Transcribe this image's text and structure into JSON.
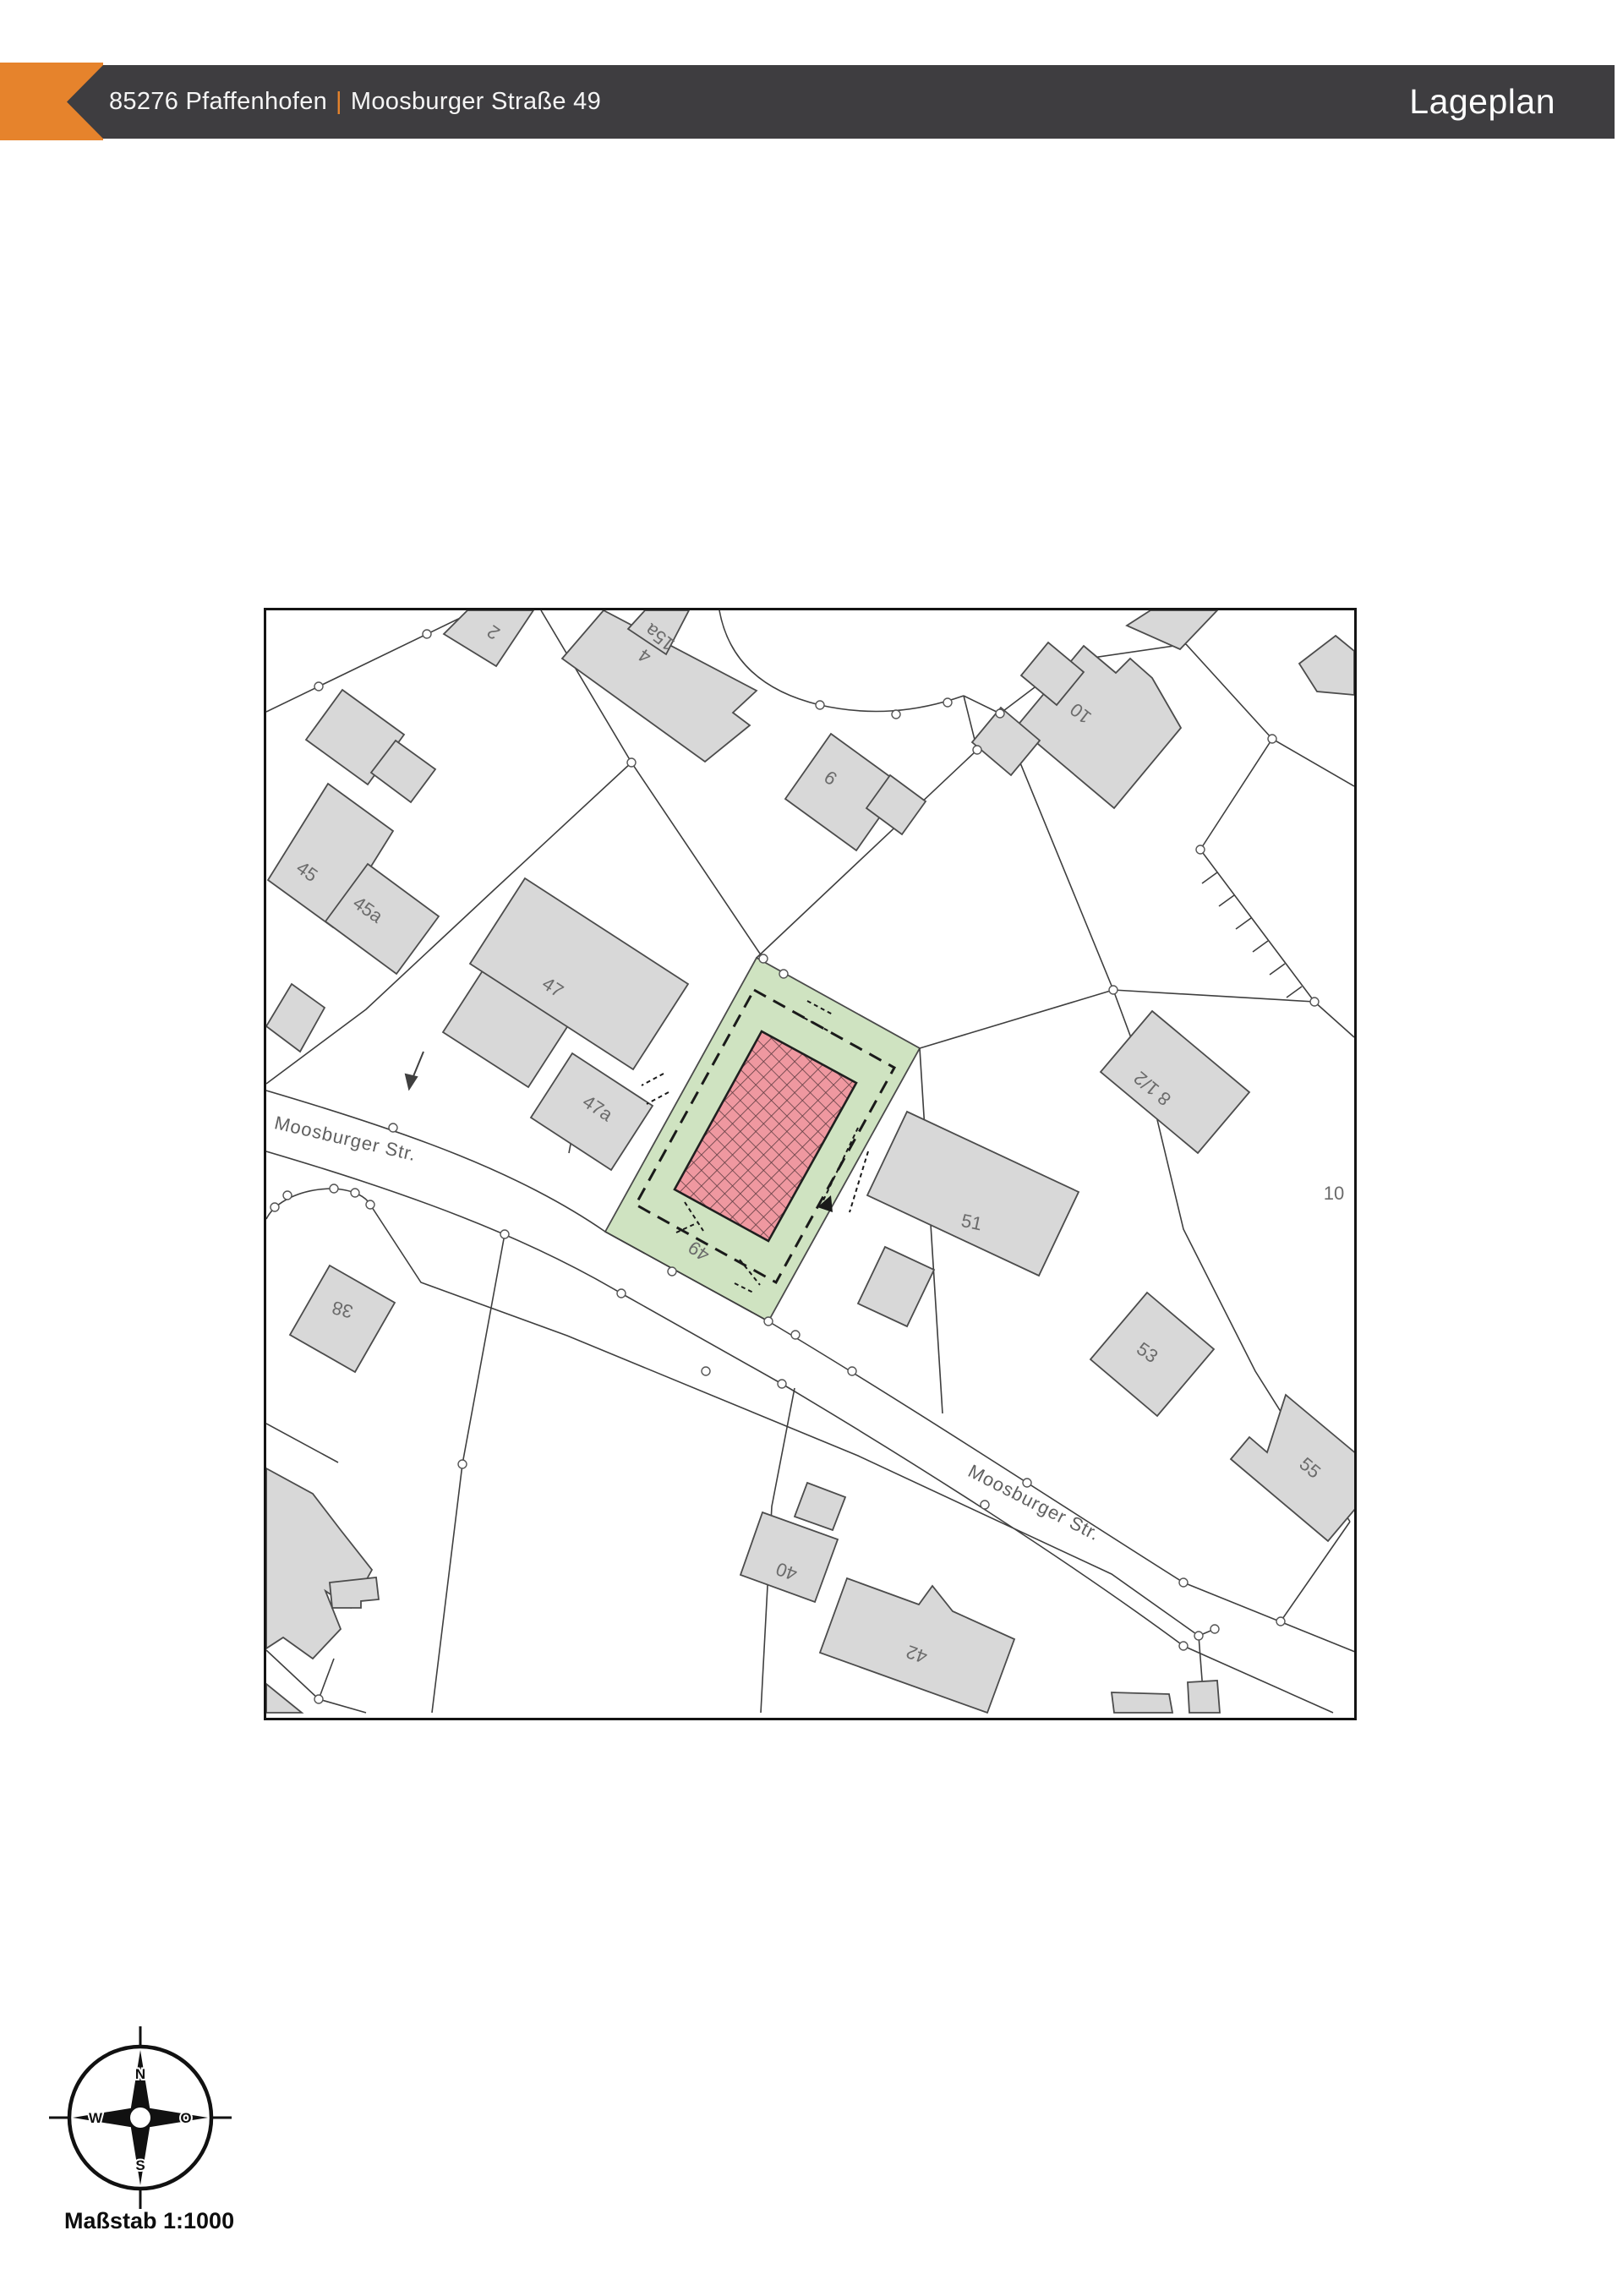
{
  "header": {
    "zip_city": "85276 Pfaffenhofen",
    "separator": "|",
    "street": "Moosburger Straße 49",
    "title": "Lageplan"
  },
  "colors": {
    "accent_orange": "#E6832C",
    "header_dark": "#3E3D40",
    "parcel_green": "#CFE3C1",
    "target_building_pink": "#EF98A0",
    "building_gray": "#D8D8D8",
    "parcel_line": "#3F3F3F"
  },
  "map": {
    "labels": [
      {
        "text": "2"
      },
      {
        "text": "4"
      },
      {
        "text": "15a"
      },
      {
        "text": "9"
      },
      {
        "text": "10"
      },
      {
        "text": "8 1/2"
      },
      {
        "text": "45"
      },
      {
        "text": "45a"
      },
      {
        "text": "47"
      },
      {
        "text": "47a"
      },
      {
        "text": "38"
      },
      {
        "text": "49"
      },
      {
        "text": "51"
      },
      {
        "text": "53"
      },
      {
        "text": "55"
      },
      {
        "text": "40"
      },
      {
        "text": "42"
      },
      {
        "text": "10"
      },
      {
        "text": "Moosburger Str."
      },
      {
        "text": "Moosburger Str."
      }
    ]
  },
  "compass": {
    "north": "N",
    "east": "O",
    "south": "S",
    "west": "W"
  },
  "scale": {
    "label": "Maßstab 1:1000"
  }
}
